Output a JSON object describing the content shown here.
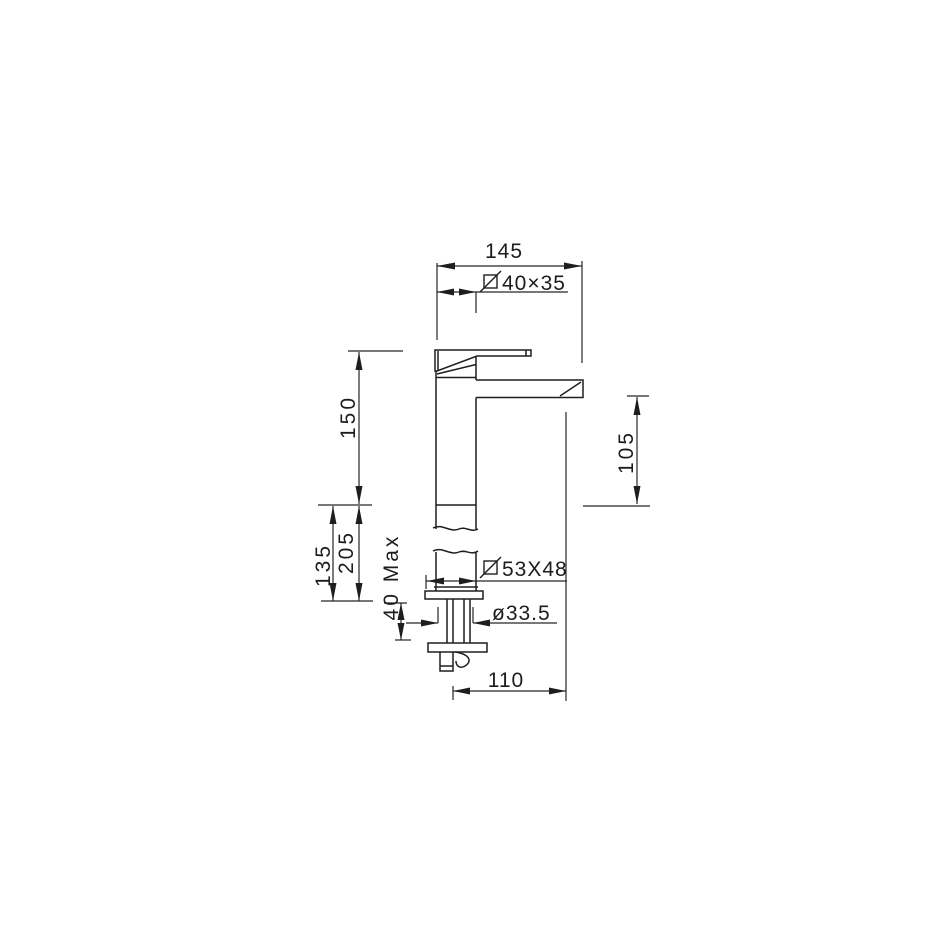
{
  "drawing": {
    "type": "faucet-technical-drawing",
    "line_color": "#1e1e1e",
    "background": "#ffffff"
  },
  "dimensions": {
    "overall_width": "145",
    "spout_section": "40×35",
    "upper_height": "150",
    "lower_height_a": "135",
    "lower_height_b": "205",
    "counter_max": "40 Max",
    "base_section": "53X48",
    "shank_diameter": "ø33.5",
    "spout_height": "105",
    "base_reach": "110"
  }
}
